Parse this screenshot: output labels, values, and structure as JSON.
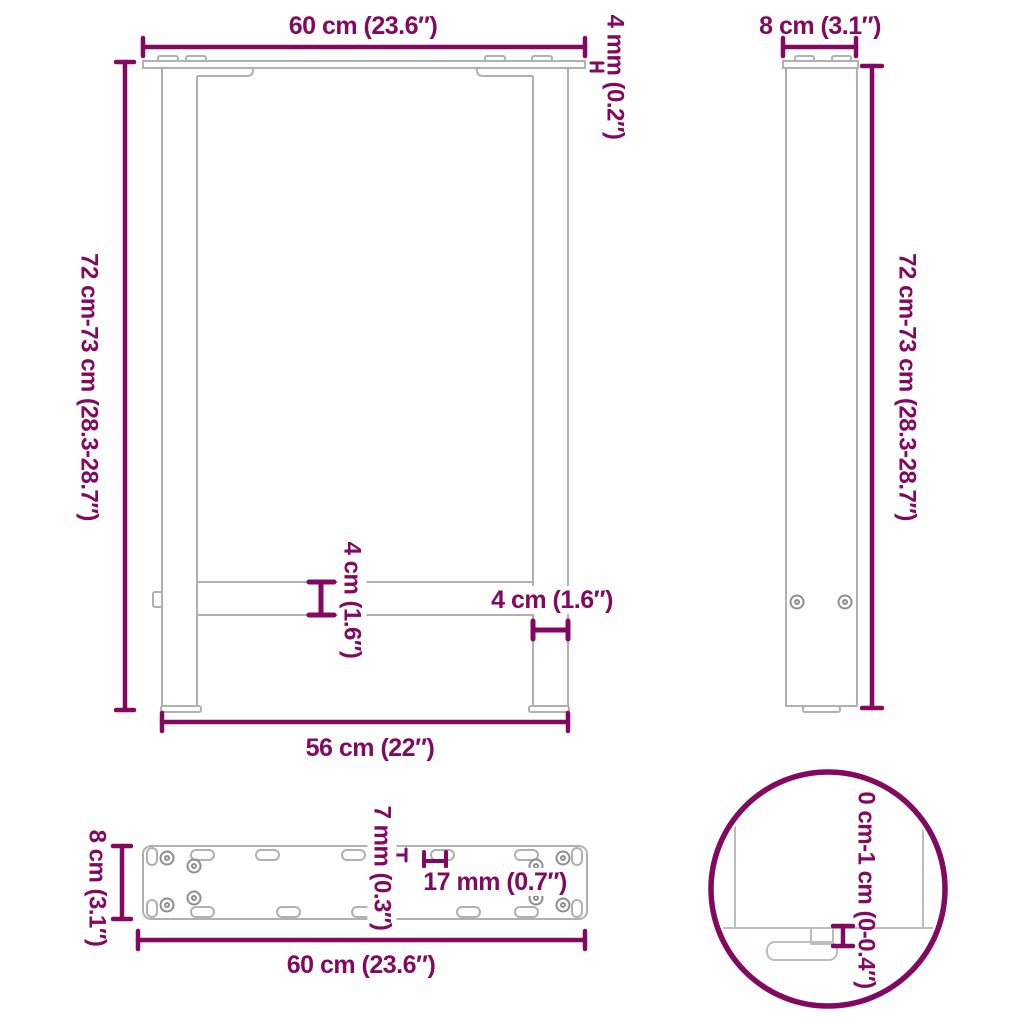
{
  "drawing": {
    "type": "furniture-dimension-diagram",
    "subject": "table-legs",
    "accent_color": "#83085F",
    "structure_color": "#B0B0B0",
    "background_color": "#FFFFFF",
    "front_view": {
      "top_width": "60 cm (23.6″)",
      "plate_thickness": "4 mm (0.2″)",
      "height_range": "72 cm-73 cm (28.3-28.7″)",
      "crossbar_thickness": "4 cm (1.6″)",
      "leg_width": "4 cm (1.6″)",
      "bottom_width": "56 cm (22″)"
    },
    "side_view": {
      "depth": "8 cm (3.1″)",
      "height_range": "72 cm-73 cm (28.3-28.7″)"
    },
    "plate_view": {
      "depth": "8 cm (3.1″)",
      "width": "60 cm (23.6″)",
      "hole_width": "7 mm (0.3″)",
      "hole_length": "17 mm (0.7″)"
    },
    "detail_view": {
      "adjustment_range": "0 cm-1 cm (0-0.4″)"
    }
  }
}
